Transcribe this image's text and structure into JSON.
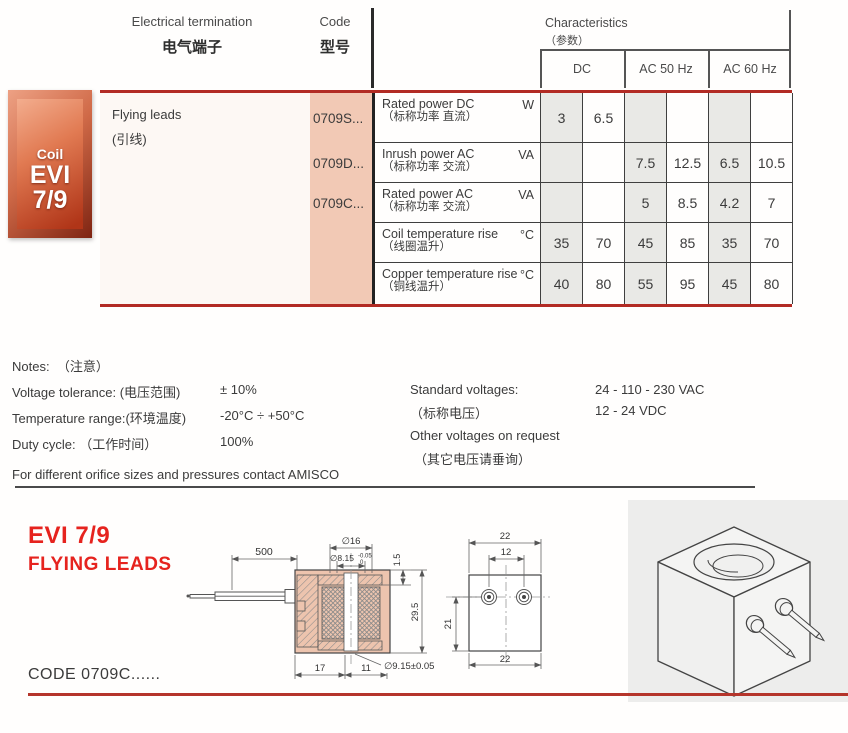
{
  "header": {
    "electrical_termination_en": "Electrical termination",
    "electrical_termination_zh": "电气端子",
    "code_en": "Code",
    "code_zh": "型号",
    "characteristics_en": "Characteristics",
    "characteristics_zh": "（参数）",
    "col_dc": "DC",
    "col_ac50": "AC 50 Hz",
    "col_ac60": "AC 60 Hz"
  },
  "badge": {
    "line1": "Coil",
    "line2": "EVI",
    "line3": "7/9"
  },
  "table": {
    "termination_en": "Flying leads",
    "termination_zh": "(引线)",
    "codes": [
      "0709S...",
      "0709D...",
      "0709C..."
    ],
    "rows": [
      {
        "label_en": "Rated power DC",
        "label_zh": "（标称功率 直流）",
        "unit": "W",
        "values": [
          "3",
          "6.5",
          "",
          "",
          "",
          ""
        ]
      },
      {
        "label_en": "Inrush power AC",
        "label_zh": "（标称功率 交流）",
        "unit": "VA",
        "values": [
          "",
          "",
          "7.5",
          "12.5",
          "6.5",
          "10.5"
        ]
      },
      {
        "label_en": "Rated power AC",
        "label_zh": "（标称功率 交流）",
        "unit": "VA",
        "values": [
          "",
          "",
          "5",
          "8.5",
          "4.2",
          "7"
        ]
      },
      {
        "label_en": "Coil temperature rise",
        "label_zh": "（线圈温升）",
        "unit": "°C",
        "values": [
          "35",
          "70",
          "45",
          "85",
          "35",
          "70"
        ]
      },
      {
        "label_en": "Copper temperature rise",
        "label_zh": "（铜线温升）",
        "unit": "°C",
        "values": [
          "40",
          "80",
          "55",
          "95",
          "45",
          "80"
        ]
      }
    ]
  },
  "notes": {
    "title_en": "Notes:",
    "title_zh": "（注意）",
    "voltage_label": "Voltage tolerance:",
    "voltage_zh": "(电压范围)",
    "voltage_value": "± 10%",
    "temp_label": "Temperature range:",
    "temp_zh": "(环境温度)",
    "temp_value": "-20°C ÷ +50°C",
    "duty_label": "Duty cycle:",
    "duty_zh": "（工作时间）",
    "duty_value": "100%",
    "footer": "For different orifice sizes and pressures contact AMISCO"
  },
  "voltages": {
    "std_label": "Standard voltages:",
    "std_zh": "（标称电压）",
    "std_value1": "24 - 110 - 230 VAC",
    "std_value2": "12 - 24 VDC",
    "other_label": "Other voltages on request",
    "other_zh": "（其它电压请垂询）"
  },
  "footer": {
    "title_line1": "EVI 7/9",
    "title_line2": "FLYING LEADS",
    "code_text": "CODE 0709C......"
  },
  "drawings": {
    "side_view": {
      "lead_length": "500",
      "dia_top": "∅16",
      "dia_bore": "∅8.15",
      "bore_tol_upper": "-0.05",
      "bore_tol_lower": "0",
      "plate_thickness": "1.5",
      "height": "29.5",
      "dia_bottom": "∅9.15±0.05",
      "width_left": "17",
      "width_right": "11"
    },
    "front_view": {
      "width_top": "22",
      "pin_spacing": "12",
      "pin_height": "21",
      "width_bottom": "22"
    }
  },
  "colors": {
    "accent_red": "#e6231e",
    "line_red": "#b22b24",
    "peach": "#f2c9b5",
    "cell_gray": "#e9e9e6",
    "panel_gray": "#ededec"
  }
}
